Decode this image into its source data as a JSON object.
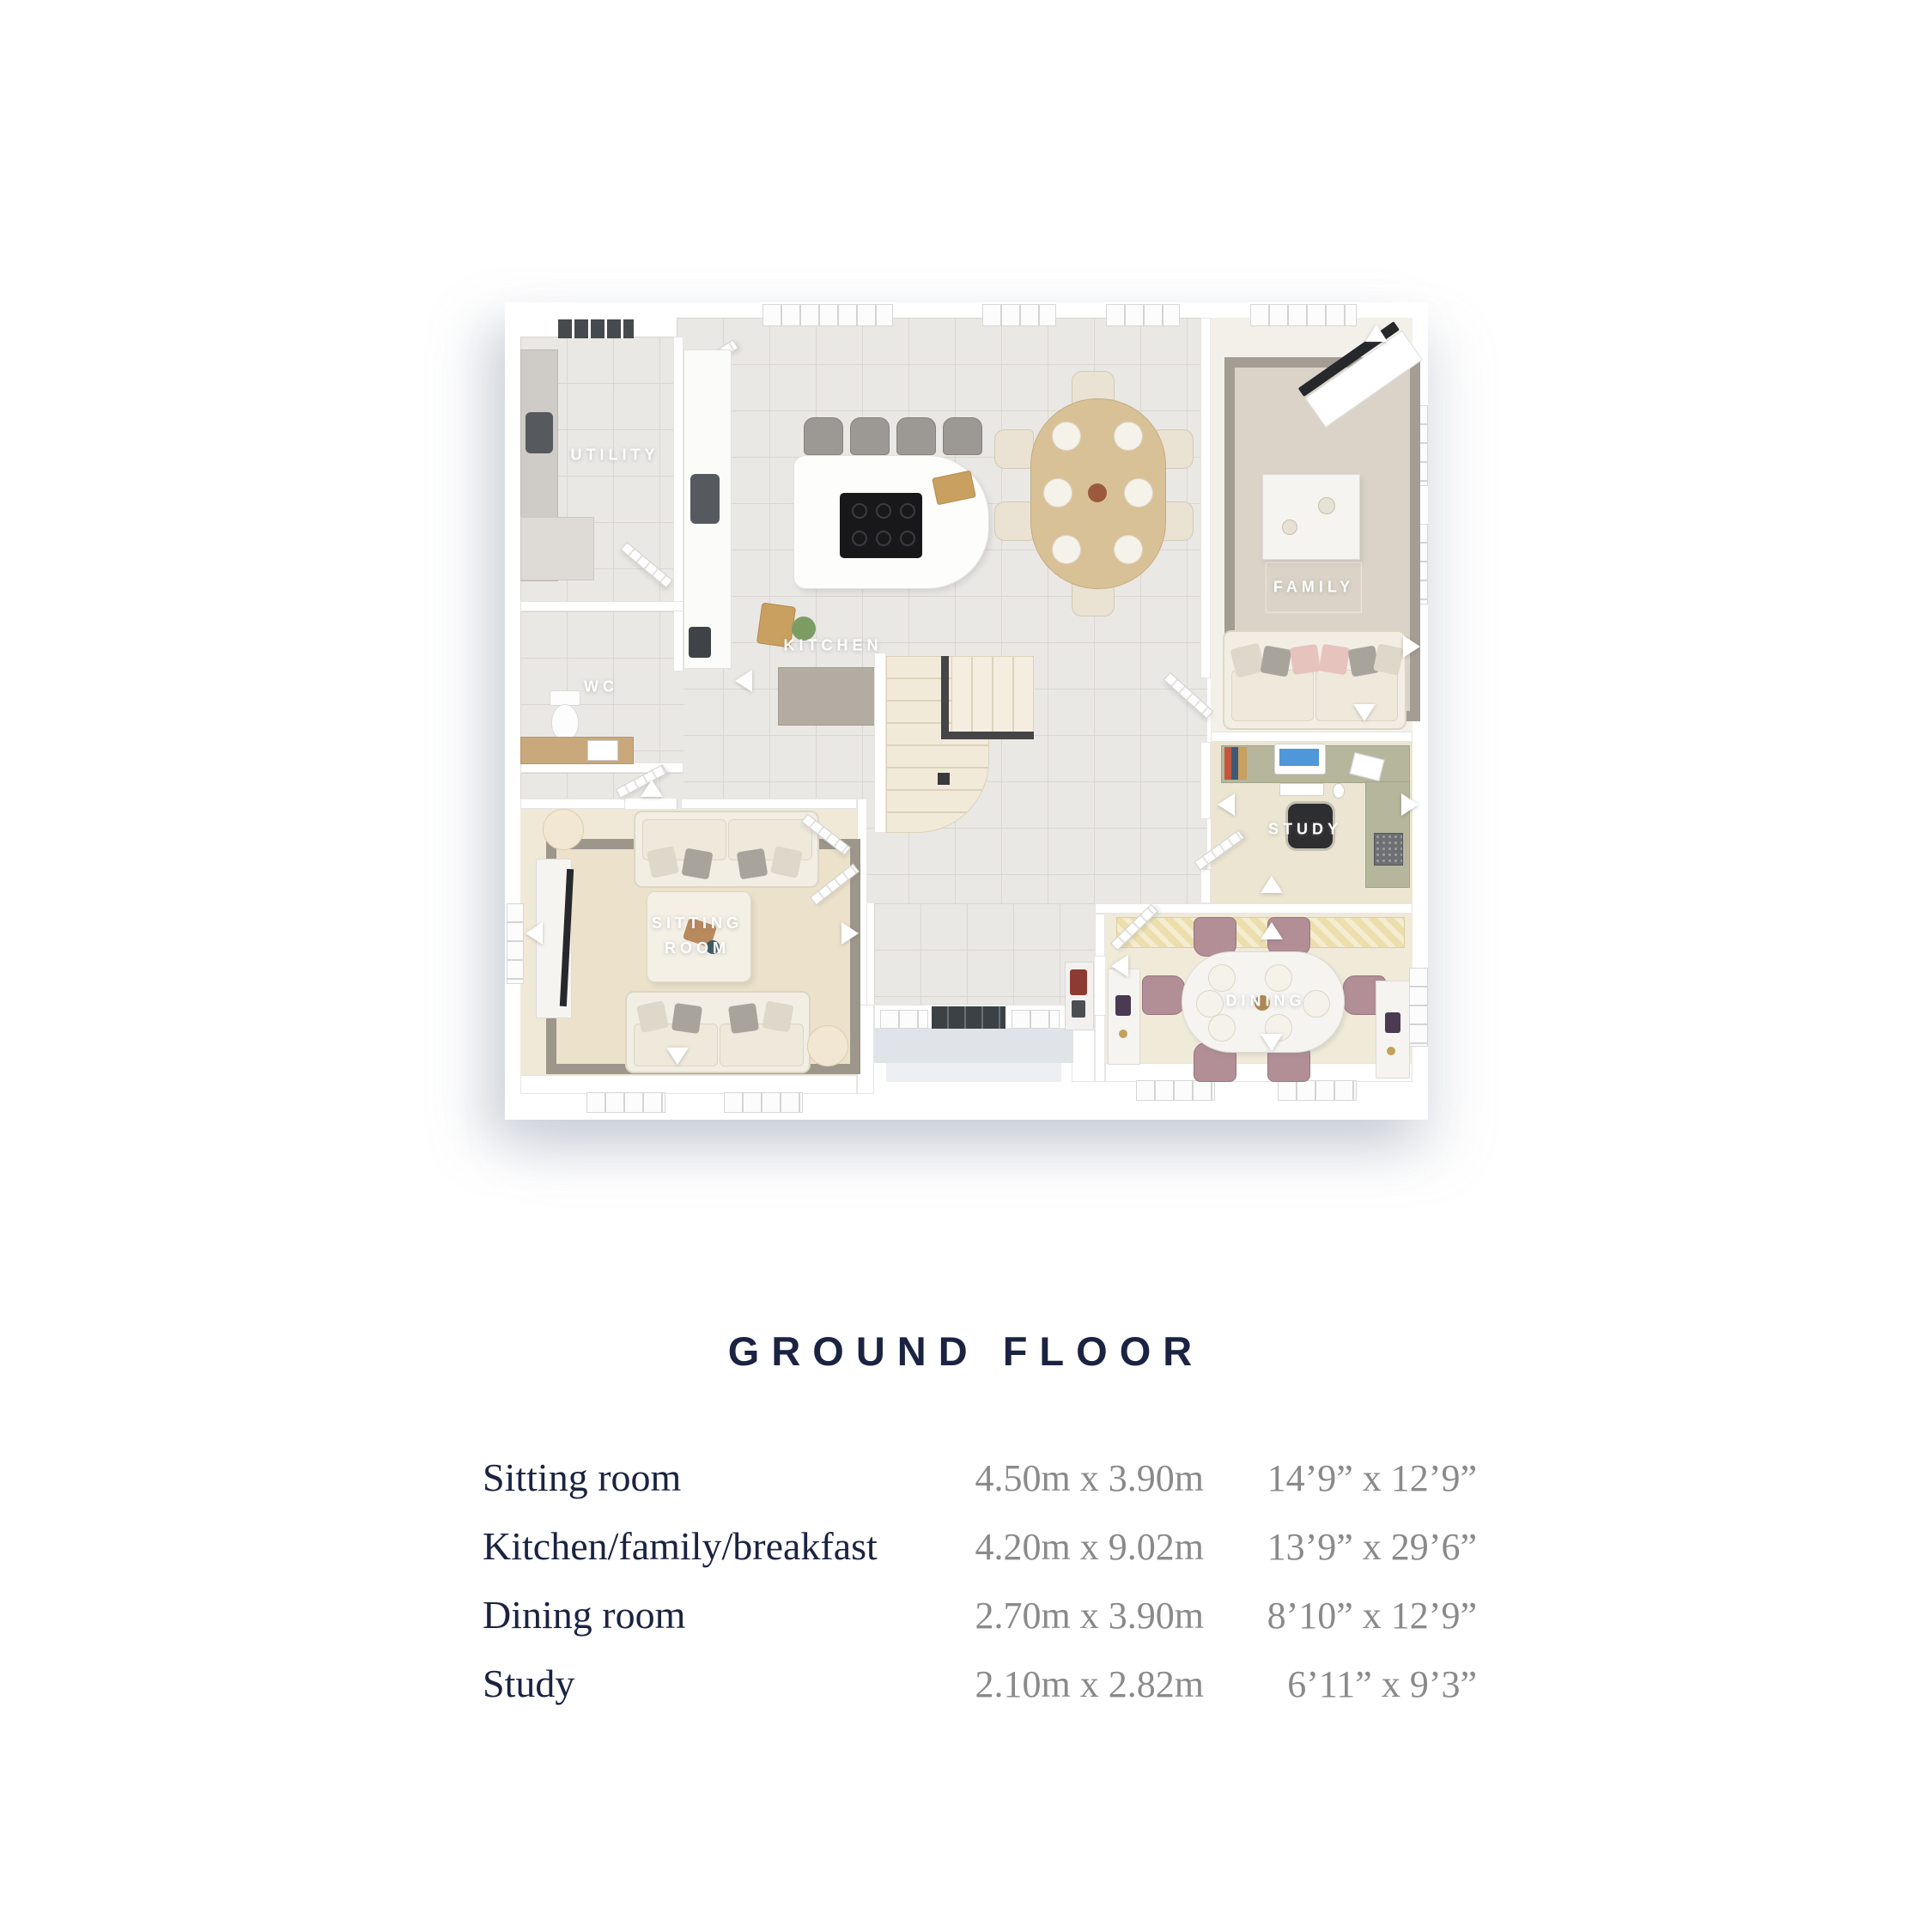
{
  "title": "GROUND FLOOR",
  "floorplan": {
    "rooms": [
      {
        "id": "utility",
        "label": "UTILITY"
      },
      {
        "id": "wc",
        "label": "WC"
      },
      {
        "id": "kitchen",
        "label": "KITCHEN"
      },
      {
        "id": "family",
        "label": "FAMILY"
      },
      {
        "id": "study",
        "label": "STUDY"
      },
      {
        "id": "sitting-room",
        "label": "SITTING ROOM"
      },
      {
        "id": "dining",
        "label": "DINING"
      }
    ]
  },
  "dimensions": {
    "rows": [
      {
        "room": "Sitting room",
        "metric": "4.50m x 3.90m",
        "imperial": "14’9” x 12’9”"
      },
      {
        "room": "Kitchen/family/breakfast",
        "metric": "4.20m x 9.02m",
        "imperial": "13’9” x 29’6”"
      },
      {
        "room": "Dining room",
        "metric": "2.70m x 3.90m",
        "imperial": "8’10” x 12’9”"
      },
      {
        "room": "Study",
        "metric": "2.10m x 2.82m",
        "imperial": "6’11” x 9’3”"
      }
    ]
  },
  "colors": {
    "heading_navy": "#1b2342",
    "measurement_grey": "#8a8a8a",
    "plan_label_white": "#ffffff",
    "tile_floor": "#eae8e5",
    "carpet_beige": "#ece2cb",
    "rug_border_grey": "#9d968b",
    "study_desk_sage": "#b5b69c",
    "dining_runner_yellow": "#ecdfad",
    "dining_chair_mauve": "#b28e96",
    "front_door_dark": "#3c4146"
  }
}
